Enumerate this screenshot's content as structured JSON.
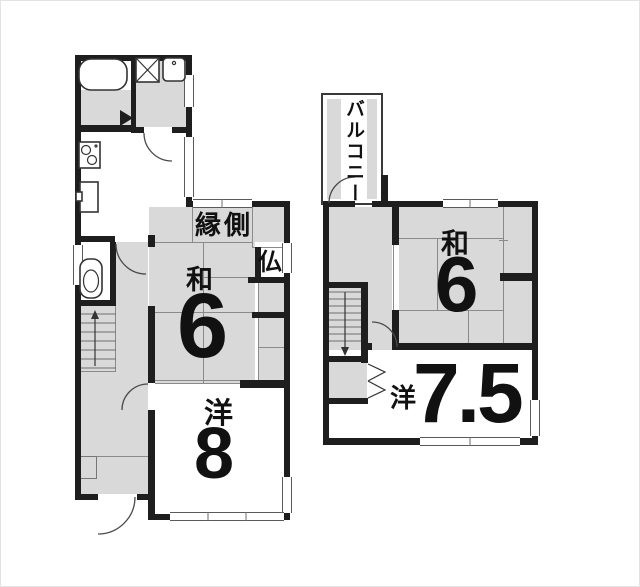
{
  "colors": {
    "wall": "#1e1e1e",
    "tatami": "#d9d9d9",
    "bg": "#ffffff",
    "text": "#111111"
  },
  "floor1": {
    "engawa_label": "縁側",
    "butsudan_label": "仏",
    "tatami_room": {
      "type_label": "和",
      "size_label": "6"
    },
    "western_room": {
      "type_label": "洋",
      "size_label": "8"
    }
  },
  "floor2": {
    "balcony_label": "バルコニー",
    "tatami_room": {
      "type_label": "和",
      "size_label": "6"
    },
    "western_room": {
      "type_label": "洋",
      "size_label": "7.5"
    }
  }
}
